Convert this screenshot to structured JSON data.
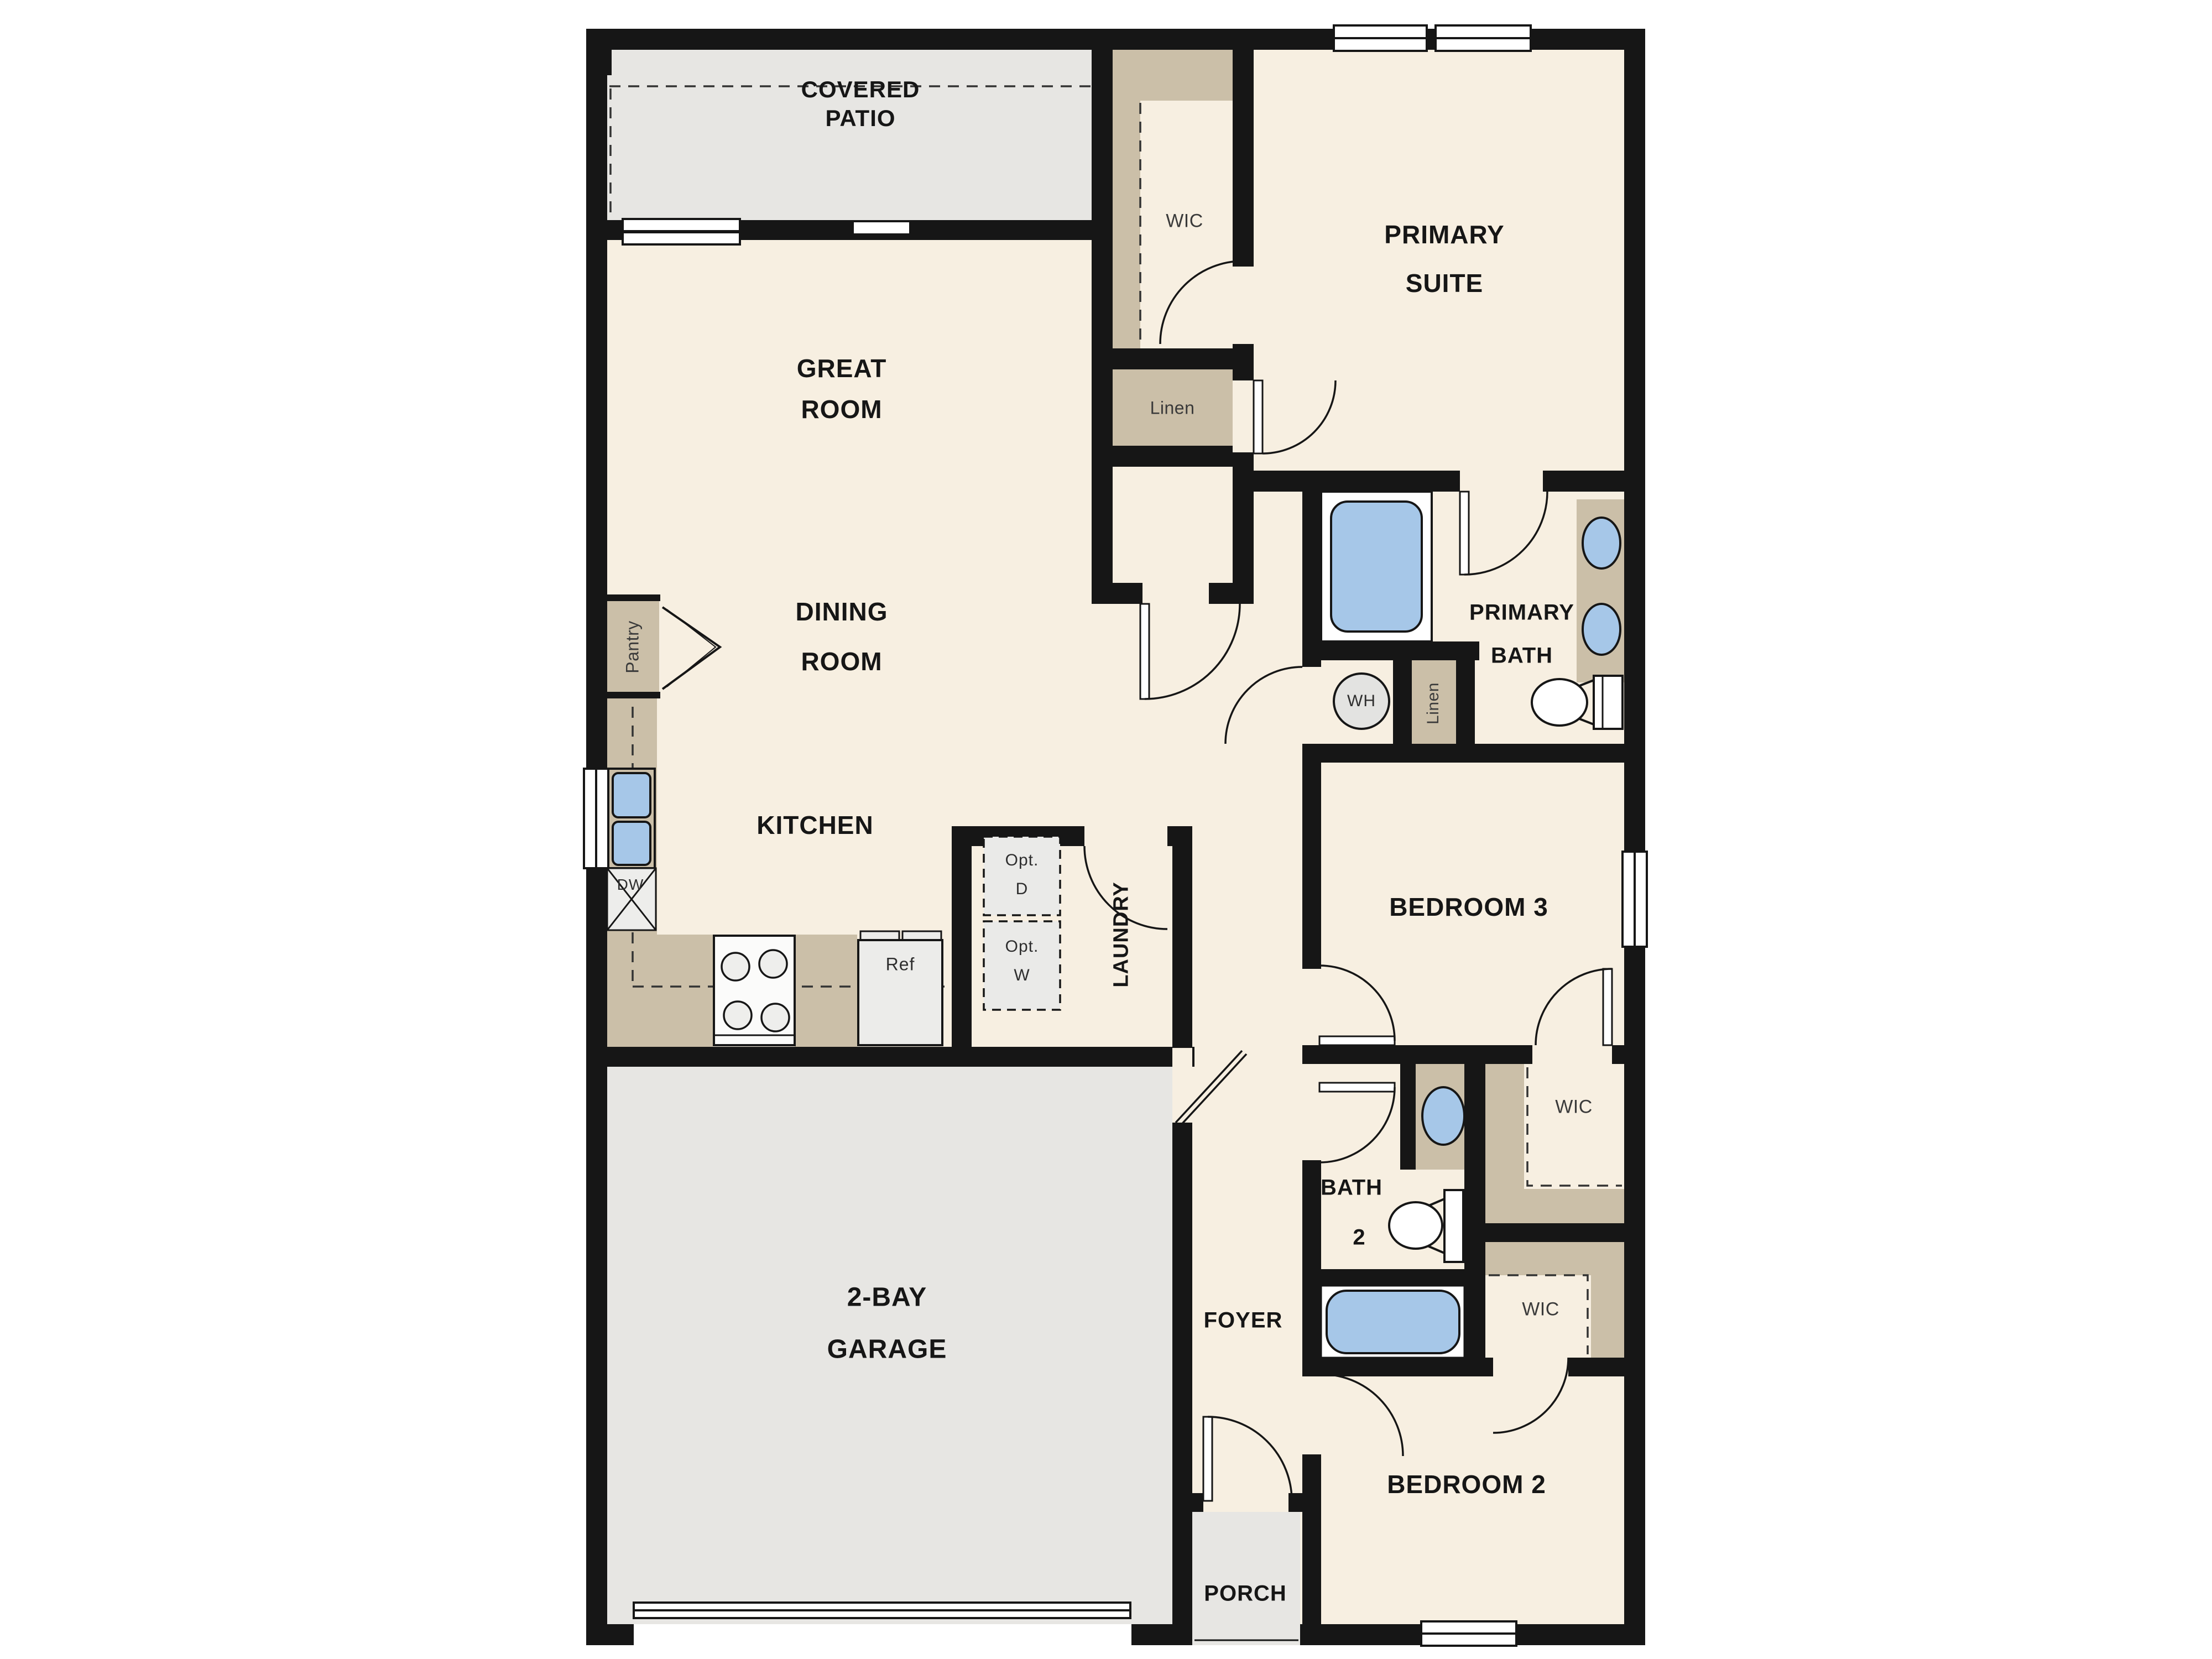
{
  "document": {
    "type": "floor-plan",
    "title": "Single-story 3-bedroom floor plan with 2-bay garage"
  },
  "colors": {
    "wall": "#161616",
    "floor": "#f7efe1",
    "patio_garage_gray": "#e7e6e3",
    "cabinet_tan": "#cbbfa8",
    "fixture_blue": "#a6c7e8",
    "appliance_gray": "#ececea",
    "label_dark": "#161616",
    "label_gray": "#3a3a3a"
  },
  "labels": {
    "covered_patio": [
      "COVERED",
      "PATIO"
    ],
    "great_room": [
      "GREAT",
      "ROOM"
    ],
    "dining_room": [
      "DINING",
      "ROOM"
    ],
    "kitchen": "KITCHEN",
    "pantry": "Pantry",
    "wic_primary": "WIC",
    "primary_suite": [
      "PRIMARY",
      "SUITE"
    ],
    "linen_hall": "Linen",
    "primary_bath": [
      "PRIMARY",
      "BATH"
    ],
    "linen_bath": "Linen",
    "water_heater": "WH",
    "dishwasher": "DW",
    "refrigerator": "Ref",
    "opt_dryer": [
      "Opt.",
      "D"
    ],
    "opt_washer": [
      "Opt.",
      "W"
    ],
    "laundry": "LAUNDRY",
    "bedroom3": "BEDROOM 3",
    "wic_bedroom3": "WIC",
    "bath2": [
      "BATH",
      "2"
    ],
    "wic_bedroom2": "WIC",
    "foyer": "FOYER",
    "garage": [
      "2-BAY",
      "GARAGE"
    ],
    "bedroom2": "BEDROOM 2",
    "porch": "PORCH"
  }
}
